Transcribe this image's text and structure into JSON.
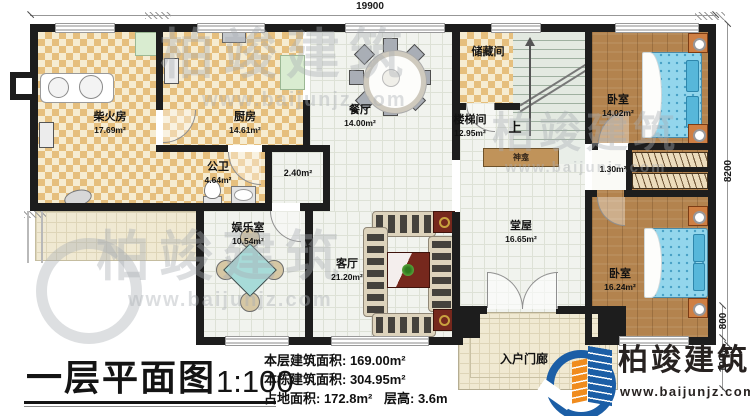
{
  "rooms": {
    "firewood": {
      "name": "柴火房",
      "area": "17.69m²"
    },
    "kitchen": {
      "name": "厨房",
      "area": "14.61m²"
    },
    "bath": {
      "name": "公卫",
      "area": "4.64m²"
    },
    "corridor": {
      "area": "2.40m²"
    },
    "dining": {
      "name": "餐厅",
      "area": "14.00m²"
    },
    "storage": {
      "name": "储藏间"
    },
    "stairwell": {
      "name": "楼梯间",
      "area": "12.95m²",
      "up": "上"
    },
    "shrine": {
      "name": "神龛"
    },
    "closet": {
      "area": "1.30m²"
    },
    "bedroom_top": {
      "name": "卧室",
      "area": "14.02m²"
    },
    "bedroom_bottom": {
      "name": "卧室",
      "area": "16.24m²"
    },
    "hall": {
      "name": "堂屋",
      "area": "16.65m²"
    },
    "living": {
      "name": "客厅",
      "area": "21.20m²"
    },
    "game": {
      "name": "娱乐室",
      "area": "10.54m²"
    },
    "porch": {
      "name": "入户门廊"
    }
  },
  "dimensions": {
    "top": "19900",
    "right": "8200",
    "porch_a": "800",
    "porch_b": "1000"
  },
  "title_block": {
    "title": "一层平面图",
    "scale": "1:100",
    "stats": [
      {
        "label": "本层建筑面积: ",
        "value": "169.00m²"
      },
      {
        "label": "本栋建筑面积: ",
        "value": "304.95m²"
      },
      {
        "label": "占地面积: ",
        "value": "172.8m²"
      },
      {
        "label": "层高: ",
        "value": "3.6m"
      }
    ]
  },
  "brand": {
    "name": "柏竣建筑",
    "url": "www.baijunjz.com"
  },
  "watermark": {
    "name": "柏竣建筑",
    "url": "www.baijunjz.com"
  },
  "colors": {
    "accent_blue": "#1b5ea6",
    "accent_orange": "#f08c1e",
    "wall": "#1d1d1d",
    "bed_blue": "#93d6ec"
  }
}
